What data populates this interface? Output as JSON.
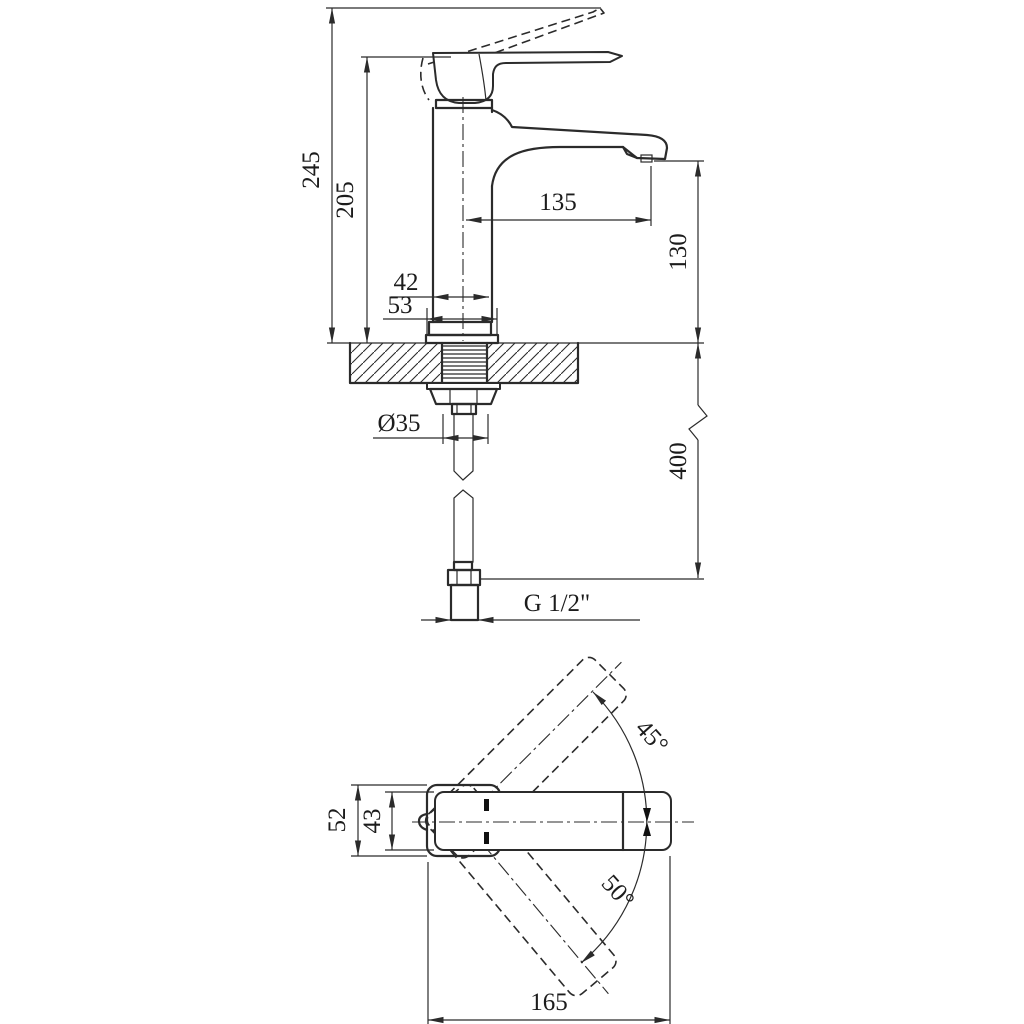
{
  "drawing": {
    "kind": "technical dimensional drawing",
    "subject": "single-lever basin mixer faucet: side elevation with deck mounting cross-section and flexible supply hose, plus top view with handle swing angles",
    "line_color": "#2b2b2b",
    "background_color": "#ffffff",
    "side_view": {
      "dims": {
        "total_height": "245",
        "handle_height": "205",
        "spout_reach": "135",
        "spout_height": "130",
        "body_width": "42",
        "base_width": "53",
        "hole_diameter": "Ø35",
        "hose_length": "400",
        "thread": "G 1/2\""
      }
    },
    "top_view": {
      "dims": {
        "body_depth": "52",
        "handle_width": "43",
        "swing_up": "45°",
        "swing_down": "50°",
        "overall_length": "165"
      }
    }
  }
}
